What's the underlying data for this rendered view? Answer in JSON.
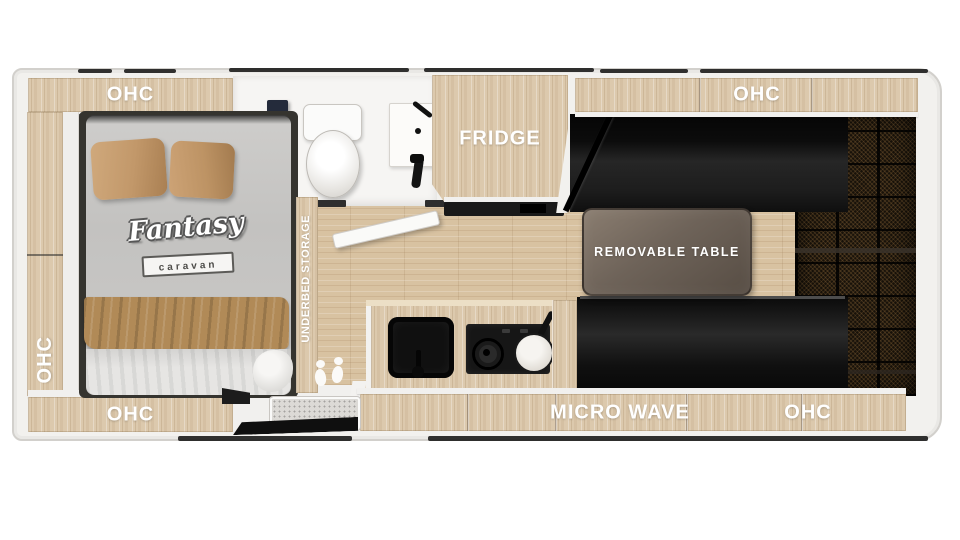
{
  "plan": {
    "type": "caravan-floor-plan",
    "brand": {
      "name": "Fantasy",
      "sub": "caravan"
    },
    "labels": {
      "ohc_top_left": "OHC",
      "ohc_left": "OHC",
      "ohc_bottom_left": "OHC",
      "ohc_top_right": "OHC",
      "ohc_bottom_right": "OHC",
      "fridge": "FRIDGE",
      "microwave": "MICRO WAVE",
      "removable_table": "REMOVABLE TABLE",
      "underbed_storage": "UNDERBED STORAGE"
    },
    "colors": {
      "cabinet_wood": "#dcc9ad",
      "floor_wood": "#d8c2a1",
      "wall_white": "#f2f1ee",
      "furniture_black": "#161616",
      "table_top": "#6e6359",
      "pillow_tan": "#c2996c",
      "blanket_tan": "#b08a58",
      "bath_cabinet_navy": "#242b3b",
      "rear_panel_dark": "#18120a",
      "label_text": "#ffffff"
    }
  }
}
